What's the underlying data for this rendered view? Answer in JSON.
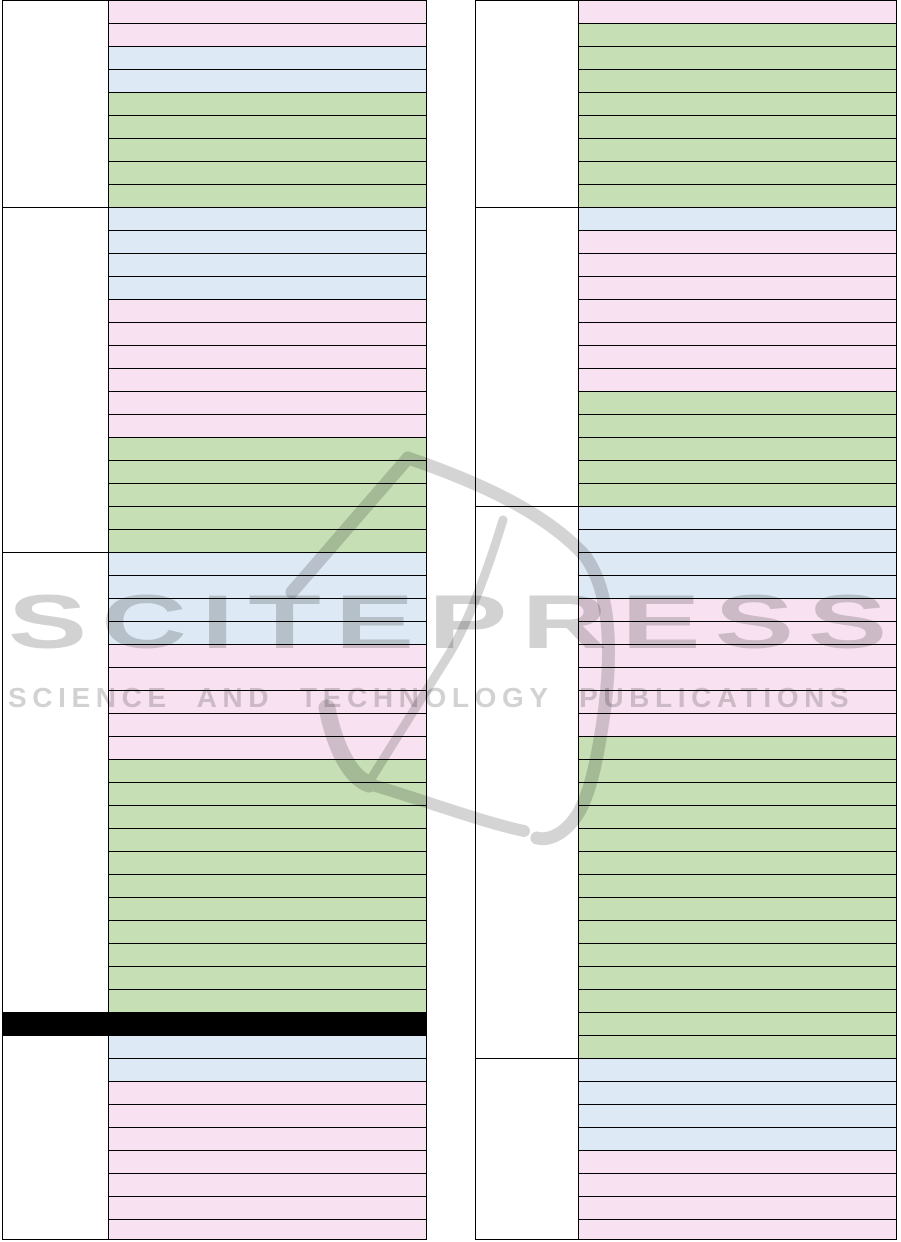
{
  "page": {
    "width": 901,
    "height": 1242,
    "background": "#ffffff"
  },
  "watermark": {
    "title": "SCITEPRESS",
    "subtitle": "SCIENCE AND TECHNOLOGY PUBLICATIONS",
    "text_color": "#d2d2d2",
    "logo": "scitepress-swoosh"
  },
  "colors": {
    "pink": "#f8e2f2",
    "blue": "#dde9f5",
    "green": "#c6dfb4",
    "redaction": "#000000",
    "border": "#000000",
    "group_cell": "#ffffff"
  },
  "row_height_px": 23,
  "tables": {
    "left": {
      "groups": [
        {
          "type": "rows",
          "rows": [
            "pink",
            "pink",
            "blue",
            "blue",
            "green",
            "green",
            "green",
            "green",
            "green"
          ]
        },
        {
          "type": "rows",
          "rows": [
            "blue",
            "blue",
            "blue",
            "blue",
            "pink",
            "pink",
            "pink",
            "pink",
            "pink",
            "pink",
            "green",
            "green",
            "green",
            "green",
            "green"
          ]
        },
        {
          "type": "rows",
          "rows": [
            "blue",
            "blue",
            "blue",
            "blue",
            "pink",
            "pink",
            "pink",
            "pink",
            "pink",
            "green",
            "green",
            "green",
            "green",
            "green",
            "green",
            "green",
            "green",
            "green",
            "green",
            "green"
          ]
        },
        {
          "type": "redaction"
        },
        {
          "type": "rows",
          "rows": [
            "blue",
            "blue",
            "pink",
            "pink",
            "pink",
            "pink",
            "pink",
            "pink",
            "pink"
          ]
        }
      ]
    },
    "right": {
      "groups": [
        {
          "type": "rows",
          "rows": [
            "pink",
            "green",
            "green",
            "green",
            "green",
            "green",
            "green",
            "green",
            "green"
          ]
        },
        {
          "type": "rows",
          "rows": [
            "blue",
            "pink",
            "pink",
            "pink",
            "pink",
            "pink",
            "pink",
            "pink",
            "green",
            "green",
            "green",
            "green",
            "green"
          ]
        },
        {
          "type": "rows",
          "rows": [
            "blue",
            "blue",
            "blue",
            "blue",
            "pink",
            "pink",
            "pink",
            "pink",
            "pink",
            "pink",
            "green",
            "green",
            "green",
            "green",
            "green",
            "green",
            "green",
            "green",
            "green",
            "green",
            "green",
            "green",
            "green",
            "green"
          ]
        },
        {
          "type": "rows",
          "rows": [
            "blue",
            "blue",
            "blue",
            "blue",
            "pink",
            "pink",
            "pink",
            "pink"
          ]
        }
      ]
    }
  }
}
